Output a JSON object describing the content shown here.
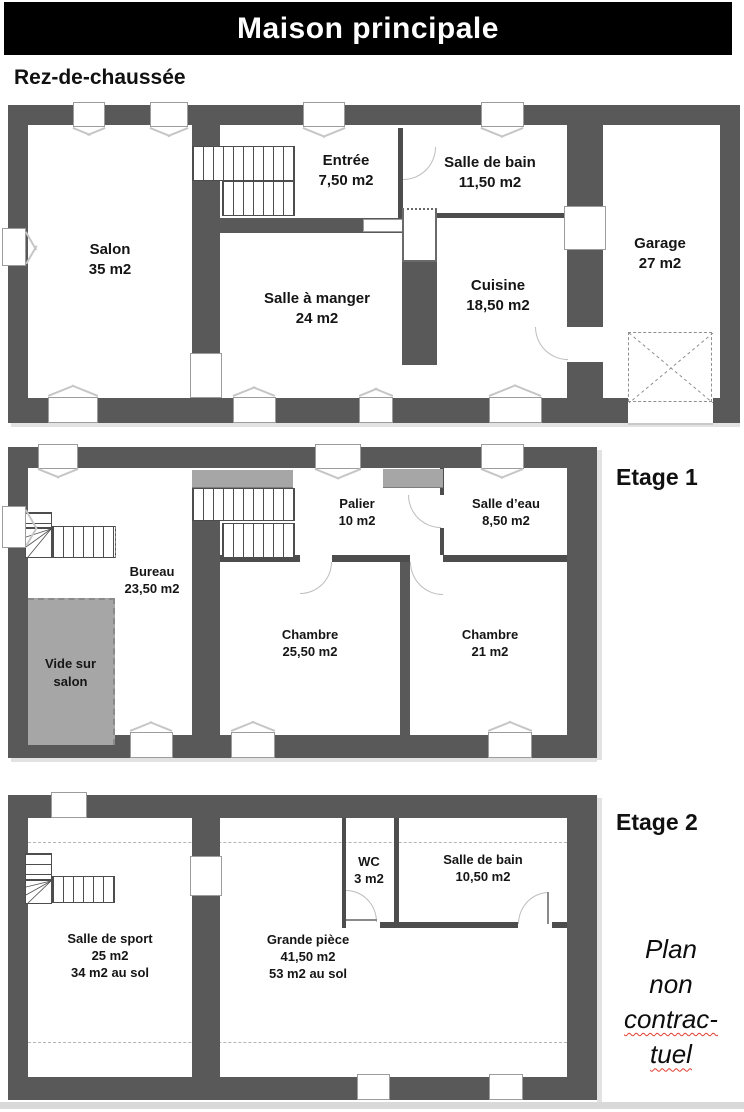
{
  "title": "Maison principale",
  "floors": [
    {
      "label": "Rez-de-chaussée",
      "rooms": [
        {
          "name": "Salon",
          "area": "35 m2"
        },
        {
          "name": "Entrée",
          "area": "7,50 m2"
        },
        {
          "name": "Salle de bain",
          "area": "11,50 m2"
        },
        {
          "name": "Salle à manger",
          "area": "24 m2"
        },
        {
          "name": "Cuisine",
          "area": "18,50 m2"
        },
        {
          "name": "Garage",
          "area": "27 m2"
        }
      ]
    },
    {
      "label": "Etage 1",
      "rooms": [
        {
          "name": "Bureau",
          "area": "23,50 m2"
        },
        {
          "name": "Palier",
          "area": "10 m2"
        },
        {
          "name": "Salle d’eau",
          "area": "8,50 m2"
        },
        {
          "name": "Chambre",
          "area": "25,50 m2"
        },
        {
          "name": "Chambre",
          "area": "21 m2"
        },
        {
          "name": "Vide sur salon",
          "area": ""
        }
      ]
    },
    {
      "label": "Etage 2",
      "rooms": [
        {
          "name": "Salle de sport",
          "area": "25 m2",
          "floor_area": "34 m2 au sol"
        },
        {
          "name": "WC",
          "area": "3 m2"
        },
        {
          "name": "Salle de bain",
          "area": "10,50 m2"
        },
        {
          "name": "Grande pièce",
          "area": "41,50 m2",
          "floor_area": "53 m2 au sol"
        }
      ]
    }
  ],
  "disclaimer": {
    "line1": "Plan",
    "line2": "non",
    "line3": "contrac-",
    "line4": "tuel"
  },
  "colors": {
    "wall": "#595959",
    "void_fill": "#a6a6a6",
    "banner": "#000000",
    "spellcheck_underline": "#e23b2e"
  }
}
